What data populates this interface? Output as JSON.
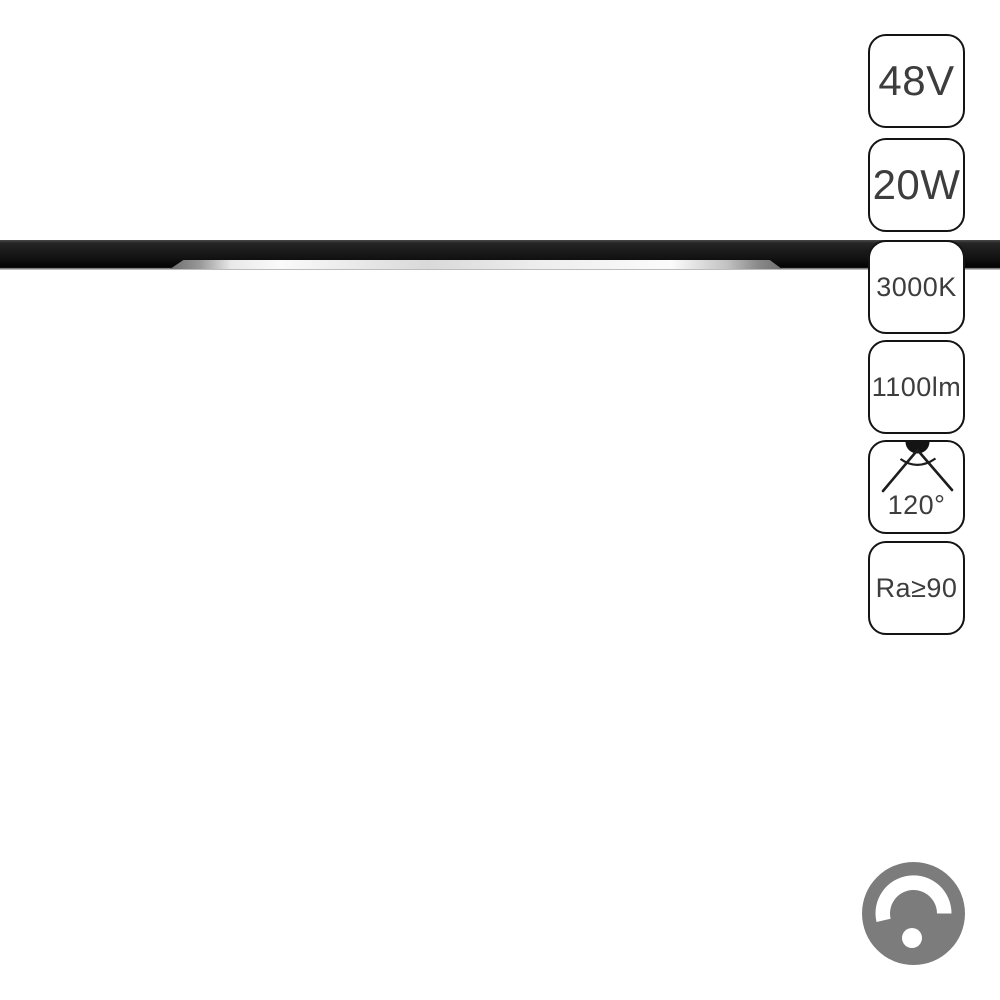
{
  "product": {
    "description": "black linear magnetic track LED light fixture",
    "badges": [
      {
        "label": "48V",
        "meaning": "voltage",
        "size": "large"
      },
      {
        "label": "20W",
        "meaning": "power",
        "size": "large"
      },
      {
        "label": "3000K",
        "meaning": "color-temperature",
        "size": "small"
      },
      {
        "label": "1100lm",
        "meaning": "luminous-flux",
        "size": "small"
      },
      {
        "label": "120°",
        "meaning": "beam-angle",
        "size": "small",
        "icon": "beam-angle-icon"
      },
      {
        "label": "Ra≥90",
        "meaning": "color-rendering",
        "size": "small"
      }
    ],
    "icons": {
      "beam_angle": "beam-angle-icon",
      "dimmer": "dimmer-knob-icon"
    }
  },
  "colors": {
    "background": "#ffffff",
    "track_black": "#161616",
    "led_white": "#f2f2f2",
    "badge_border": "#141414",
    "badge_text": "#3d3d3d",
    "dimmer_gray": "#7c7c7c"
  }
}
